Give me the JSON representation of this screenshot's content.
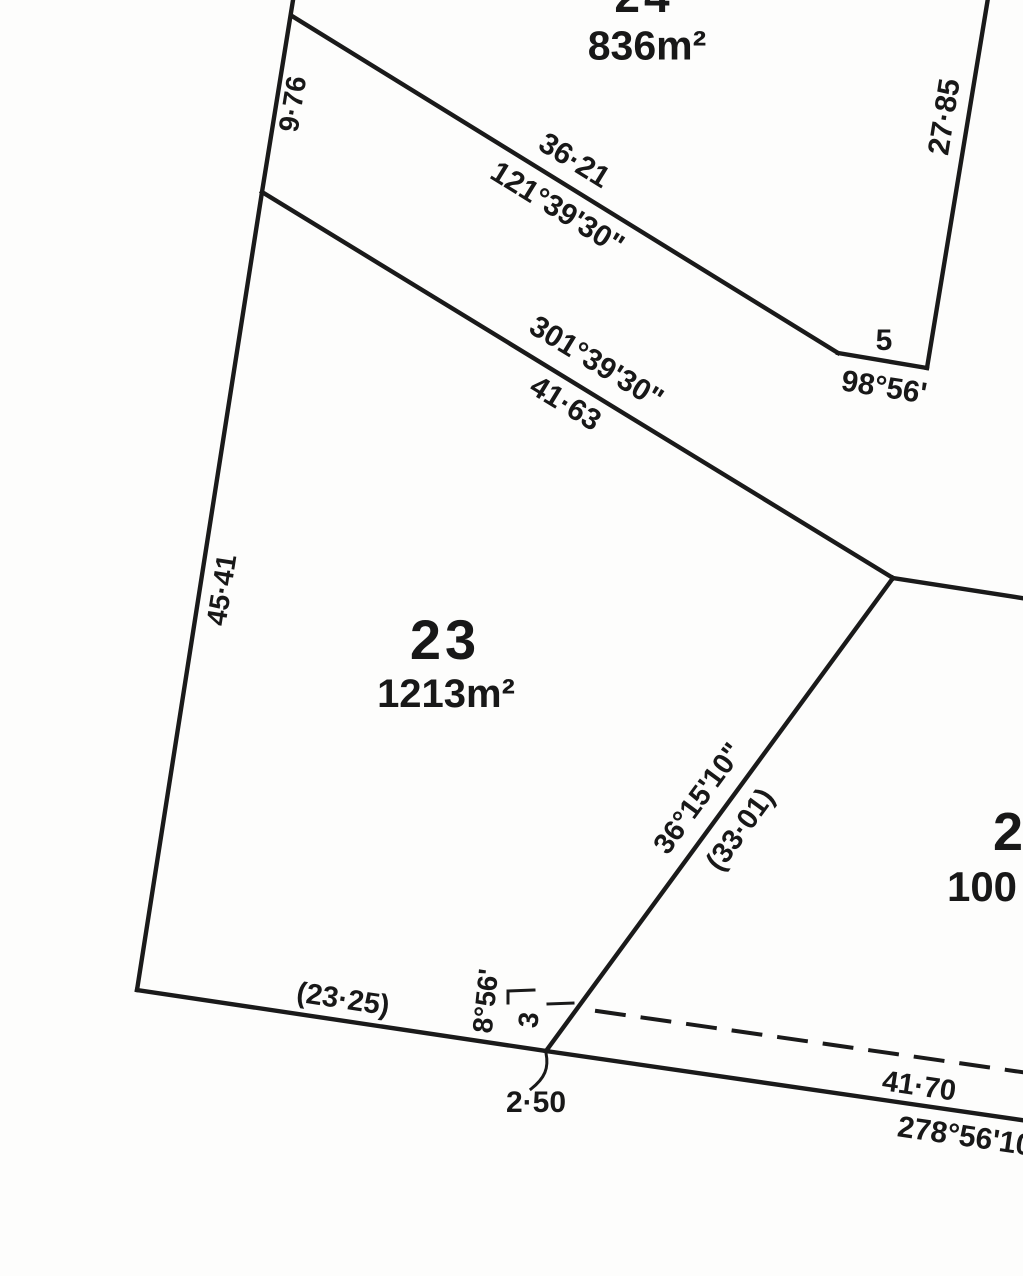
{
  "plan_type": "cadastral-subdivision-plan",
  "lots": [
    {
      "number": "24",
      "area": "836m²"
    },
    {
      "number": "23",
      "area": "1213m²"
    },
    {
      "number": "2",
      "area": "100"
    }
  ],
  "annotations": {
    "left_upper_length": "9·76",
    "top_boundary_length": "36·21",
    "top_boundary_bearing": "121°39'30\"",
    "right_boundary_length": "27·85",
    "corner_segment_length": "5",
    "corner_segment_bearing": "98°56'",
    "mid_boundary_bearing": "301°39'30\"",
    "mid_boundary_length": "41·63",
    "left_boundary_length": "45·41",
    "diagonal_bearing": "36°15'10\"",
    "diagonal_length": "(33·01)",
    "bottom_boundary_length": "(23·25)",
    "splay_bearing": "8°56'",
    "splay_length": "3",
    "splay_offset": "2·50",
    "road_length": "41·70",
    "road_bearing": "278°56'10\""
  }
}
